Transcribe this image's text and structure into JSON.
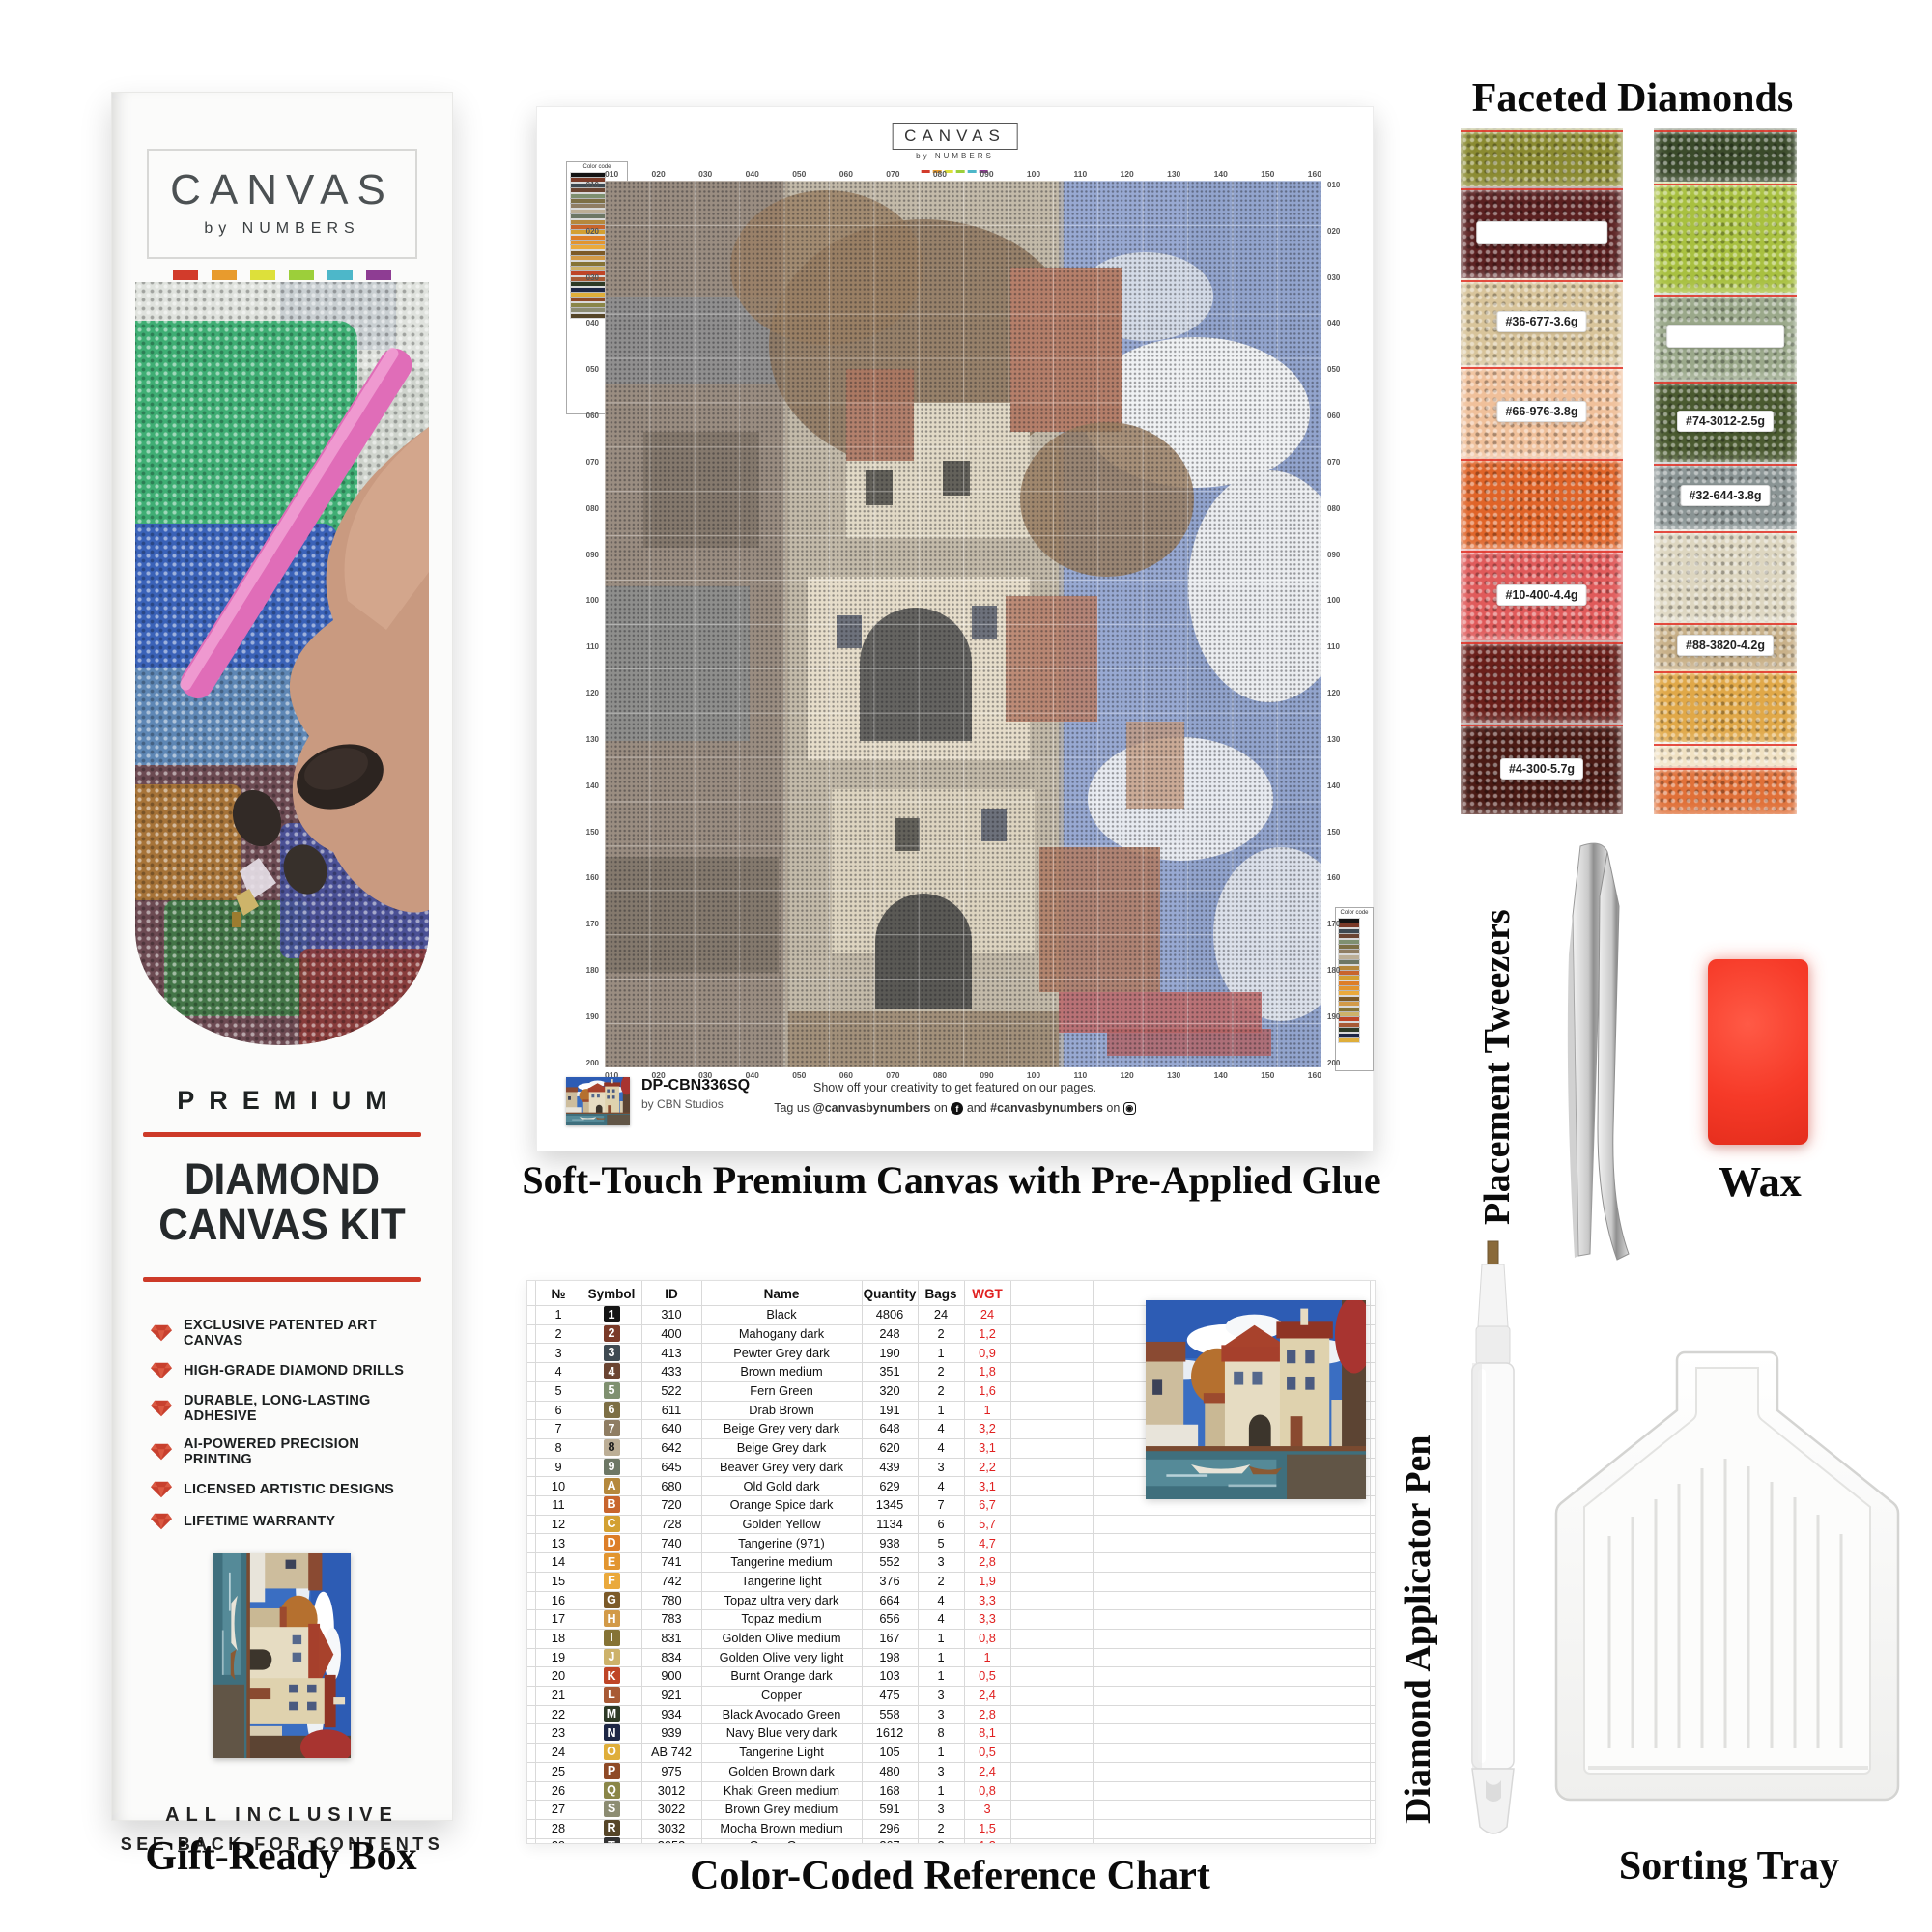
{
  "box": {
    "logo": {
      "title": "CANVAS",
      "subtitle": "by NUMBERS",
      "swatches": [
        "#d23b2b",
        "#e89b2d",
        "#dde03a",
        "#9ccf3a",
        "#4db7c9",
        "#8e3d93"
      ]
    },
    "premium": "PREMIUM",
    "title_line1": "DIAMOND",
    "title_line2": "CANVAS KIT",
    "features": [
      "EXCLUSIVE PATENTED ART CANVAS",
      "HIGH-GRADE DIAMOND DRILLS",
      "DURABLE, LONG-LASTING ADHESIVE",
      "AI-POWERED PRECISION PRINTING",
      "LICENSED ARTISTIC DESIGNS",
      "LIFETIME WARRANTY"
    ],
    "footer_line1": "ALL INCLUSIVE",
    "footer_line2": "SEE BACK FOR CONTENTS",
    "caption": "Gift-Ready Box",
    "accent_red": "#cd3a28"
  },
  "canvas": {
    "logo_title": "CANVAS",
    "logo_subtitle": "by NUMBERS",
    "legend_title": "Color code",
    "sku": "DP-CBN336SQ",
    "studio": "by CBN Studios",
    "social_line1": "Show off your creativity  to get featured on our pages.",
    "social_prefix": "Tag us ",
    "social_handle": "@canvasbynumbers",
    "social_on1": " on ",
    "social_and": " and ",
    "social_hashtag": "#canvasbynumbers",
    "social_on2": " on ",
    "facebook_icon_glyph": "f",
    "caption": "Soft-Touch Premium Canvas with Pre-Applied Glue",
    "ruler_top": [
      "010",
      "020",
      "030",
      "040",
      "050",
      "060",
      "070",
      "080",
      "090",
      "100",
      "110",
      "120",
      "130",
      "140",
      "150",
      "160"
    ],
    "ruler_bottom": [
      "010",
      "020",
      "030",
      "040",
      "050",
      "060",
      "070",
      "080",
      "090",
      "100",
      "110",
      "120",
      "130",
      "140",
      "150",
      "160"
    ],
    "ruler_left": [
      "010",
      "020",
      "030",
      "040",
      "050",
      "060",
      "070",
      "080",
      "090",
      "100",
      "110",
      "120",
      "130",
      "140",
      "150",
      "160",
      "170",
      "180",
      "190",
      "200"
    ],
    "ruler_right": [
      "010",
      "020",
      "030",
      "040",
      "050",
      "060",
      "070",
      "080",
      "090",
      "100",
      "110",
      "120",
      "130",
      "140",
      "150",
      "160",
      "170",
      "180",
      "190",
      "200"
    ]
  },
  "chart": {
    "caption": "Color-Coded Reference Chart",
    "headers": {
      "n": "№",
      "symbol": "Symbol",
      "id": "ID",
      "name": "Name",
      "quantity": "Quantity",
      "bags": "Bags",
      "wgt": "WGT"
    },
    "wgt_color": "#e02020",
    "rows": [
      {
        "n": "1",
        "sym": "1",
        "sym_bg": "#141414",
        "sym_fg": "#ffffff",
        "id": "310",
        "name": "Black",
        "qty": "4806",
        "bags": "24",
        "wgt": "24"
      },
      {
        "n": "2",
        "sym": "2",
        "sym_bg": "#7a3a28",
        "sym_fg": "#ffffff",
        "id": "400",
        "name": "Mahogany dark",
        "qty": "248",
        "bags": "2",
        "wgt": "1,2"
      },
      {
        "n": "3",
        "sym": "3",
        "sym_bg": "#3f4a52",
        "sym_fg": "#ffffff",
        "id": "413",
        "name": "Pewter Grey dark",
        "qty": "190",
        "bags": "1",
        "wgt": "0,9"
      },
      {
        "n": "4",
        "sym": "4",
        "sym_bg": "#6b4532",
        "sym_fg": "#ffffff",
        "id": "433",
        "name": "Brown medium",
        "qty": "351",
        "bags": "2",
        "wgt": "1,8"
      },
      {
        "n": "5",
        "sym": "5",
        "sym_bg": "#7f9070",
        "sym_fg": "#ffffff",
        "id": "522",
        "name": "Fern Green",
        "qty": "320",
        "bags": "2",
        "wgt": "1,6"
      },
      {
        "n": "6",
        "sym": "6",
        "sym_bg": "#7d6f45",
        "sym_fg": "#ffffff",
        "id": "611",
        "name": "Drab Brown",
        "qty": "191",
        "bags": "1",
        "wgt": "1"
      },
      {
        "n": "7",
        "sym": "7",
        "sym_bg": "#8f7d63",
        "sym_fg": "#ffffff",
        "id": "640",
        "name": "Beige Grey very dark",
        "qty": "648",
        "bags": "4",
        "wgt": "3,2"
      },
      {
        "n": "8",
        "sym": "8",
        "sym_bg": "#bcae96",
        "sym_fg": "#1c1c1c",
        "id": "642",
        "name": "Beige Grey dark",
        "qty": "620",
        "bags": "4",
        "wgt": "3,1"
      },
      {
        "n": "9",
        "sym": "9",
        "sym_bg": "#6d7765",
        "sym_fg": "#ffffff",
        "id": "645",
        "name": "Beaver Grey very dark",
        "qty": "439",
        "bags": "3",
        "wgt": "2,2"
      },
      {
        "n": "10",
        "sym": "A",
        "sym_bg": "#b5883c",
        "sym_fg": "#ffffff",
        "id": "680",
        "name": "Old Gold dark",
        "qty": "629",
        "bags": "4",
        "wgt": "3,1"
      },
      {
        "n": "11",
        "sym": "B",
        "sym_bg": "#c8652d",
        "sym_fg": "#ffffff",
        "id": "720",
        "name": "Orange Spice dark",
        "qty": "1345",
        "bags": "7",
        "wgt": "6,7"
      },
      {
        "n": "12",
        "sym": "C",
        "sym_bg": "#d3a032",
        "sym_fg": "#ffffff",
        "id": "728",
        "name": "Golden Yellow",
        "qty": "1134",
        "bags": "6",
        "wgt": "5,7"
      },
      {
        "n": "13",
        "sym": "D",
        "sym_bg": "#dd7e28",
        "sym_fg": "#ffffff",
        "id": "740",
        "name": "Tangerine (971)",
        "qty": "938",
        "bags": "5",
        "wgt": "4,7"
      },
      {
        "n": "14",
        "sym": "E",
        "sym_bg": "#e2952f",
        "sym_fg": "#ffffff",
        "id": "741",
        "name": "Tangerine medium",
        "qty": "552",
        "bags": "3",
        "wgt": "2,8"
      },
      {
        "n": "15",
        "sym": "F",
        "sym_bg": "#eaa93c",
        "sym_fg": "#ffffff",
        "id": "742",
        "name": "Tangerine light",
        "qty": "376",
        "bags": "2",
        "wgt": "1,9"
      },
      {
        "n": "16",
        "sym": "G",
        "sym_bg": "#7c5a28",
        "sym_fg": "#ffffff",
        "id": "780",
        "name": "Topaz ultra very dark",
        "qty": "664",
        "bags": "4",
        "wgt": "3,3"
      },
      {
        "n": "17",
        "sym": "H",
        "sym_bg": "#d29a48",
        "sym_fg": "#ffffff",
        "id": "783",
        "name": "Topaz medium",
        "qty": "656",
        "bags": "4",
        "wgt": "3,3"
      },
      {
        "n": "18",
        "sym": "I",
        "sym_bg": "#857335",
        "sym_fg": "#ffffff",
        "id": "831",
        "name": "Golden Olive medium",
        "qty": "167",
        "bags": "1",
        "wgt": "0,8"
      },
      {
        "n": "19",
        "sym": "J",
        "sym_bg": "#cdb26a",
        "sym_fg": "#ffffff",
        "id": "834",
        "name": "Golden Olive very light",
        "qty": "198",
        "bags": "1",
        "wgt": "1"
      },
      {
        "n": "20",
        "sym": "K",
        "sym_bg": "#bf4527",
        "sym_fg": "#ffffff",
        "id": "900",
        "name": "Burnt Orange dark",
        "qty": "103",
        "bags": "1",
        "wgt": "0,5"
      },
      {
        "n": "21",
        "sym": "L",
        "sym_bg": "#a85a35",
        "sym_fg": "#ffffff",
        "id": "921",
        "name": "Copper",
        "qty": "475",
        "bags": "3",
        "wgt": "2,4"
      },
      {
        "n": "22",
        "sym": "M",
        "sym_bg": "#2e3a26",
        "sym_fg": "#ffffff",
        "id": "934",
        "name": "Black Avocado Green",
        "qty": "558",
        "bags": "3",
        "wgt": "2,8"
      },
      {
        "n": "23",
        "sym": "N",
        "sym_bg": "#1e2745",
        "sym_fg": "#ffffff",
        "id": "939",
        "name": "Navy Blue very dark",
        "qty": "1612",
        "bags": "8",
        "wgt": "8,1"
      },
      {
        "n": "24",
        "sym": "O",
        "sym_bg": "#dfae3a",
        "sym_fg": "#ffffff",
        "id": "AB 742",
        "name": "Tangerine Light",
        "qty": "105",
        "bags": "1",
        "wgt": "0,5"
      },
      {
        "n": "25",
        "sym": "P",
        "sym_bg": "#8f4a26",
        "sym_fg": "#ffffff",
        "id": "975",
        "name": "Golden Brown dark",
        "qty": "480",
        "bags": "3",
        "wgt": "2,4"
      },
      {
        "n": "26",
        "sym": "Q",
        "sym_bg": "#8a8648",
        "sym_fg": "#ffffff",
        "id": "3012",
        "name": "Khaki Green medium",
        "qty": "168",
        "bags": "1",
        "wgt": "0,8"
      },
      {
        "n": "27",
        "sym": "S",
        "sym_bg": "#8c8c72",
        "sym_fg": "#ffffff",
        "id": "3022",
        "name": "Brown Grey medium",
        "qty": "591",
        "bags": "3",
        "wgt": "3"
      },
      {
        "n": "28",
        "sym": "R",
        "sym_bg": "#564628",
        "sym_fg": "#ffffff",
        "id": "3032",
        "name": "Mocha Brown medium",
        "qty": "296",
        "bags": "2",
        "wgt": "1,5"
      },
      {
        "n": "29",
        "sym": "T",
        "sym_bg": "#333333",
        "sym_fg": "#ffffff",
        "id": "3052",
        "name": "Green Grey",
        "qty": "267",
        "bags": "2",
        "wgt": "1,3",
        "partial": true
      }
    ]
  },
  "diamonds": {
    "title": "Faceted Diamonds",
    "left_bags": [
      {
        "h": 60,
        "color": "#8a8a30"
      },
      {
        "h": 95,
        "color": "#5a2020",
        "label": ""
      },
      {
        "h": 90,
        "color": "#d8c49a",
        "label": "#36-677-3.6g"
      },
      {
        "h": 95,
        "color": "#f0c09a",
        "label": "#66-976-3.8g"
      },
      {
        "h": 95,
        "color": "#e06428"
      },
      {
        "h": 95,
        "color": "#e05a5a",
        "label": "#10-400-4.4g"
      },
      {
        "h": 85,
        "color": "#6a1f1a"
      },
      {
        "h": 95,
        "color": "#4a1a14",
        "label": "#4-300-5.7g"
      }
    ],
    "right_bags": [
      {
        "h": 55,
        "color": "#3a4a2a"
      },
      {
        "h": 115,
        "color": "#a8c040"
      },
      {
        "h": 90,
        "color": "#9aa88a",
        "label": ""
      },
      {
        "h": 85,
        "color": "#4a5a30",
        "label": "#74-3012-2.5g"
      },
      {
        "h": 70,
        "color": "#8a9494",
        "label": "#32-644-3.8g"
      },
      {
        "h": 95,
        "color": "#ddd6c0"
      },
      {
        "h": 50,
        "color": "#c8b088",
        "label": "#88-3820-4.2g"
      },
      {
        "h": 75,
        "color": "#e0a848"
      },
      {
        "h": 25,
        "color": "#f0e0c0"
      },
      {
        "h": 50,
        "color": "#e07038"
      }
    ]
  },
  "tools": {
    "tweezers_label": "Placement Tweezers",
    "wax_label": "Wax",
    "pen_label": "Diamond Applicator Pen",
    "tray_label": "Sorting Tray"
  }
}
